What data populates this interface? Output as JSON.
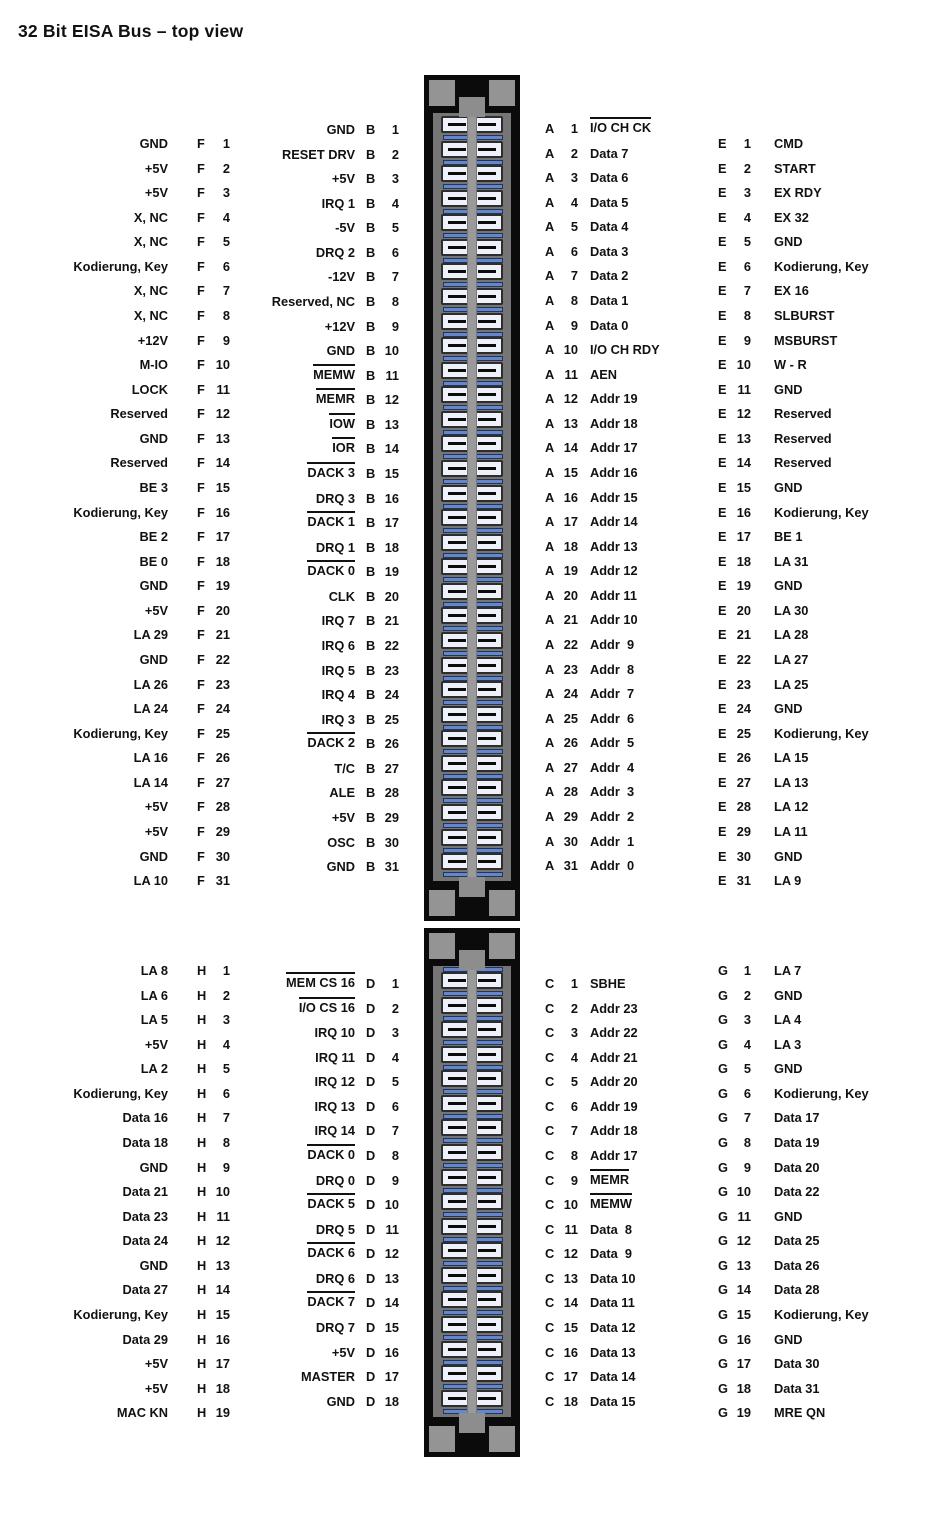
{
  "title": "32 Bit EISA Bus – top view",
  "colors": {
    "background": "#ffffff",
    "text": "#111111",
    "connector_black": "#0b0b0b",
    "key_pad_gray": "#949494",
    "panel_gray": "#757575",
    "center_bar_gray": "#9a9a9a",
    "cell_fill": "#eff1fa",
    "separator_blue": "#6486cf"
  },
  "connectors": {
    "top": {
      "cells": 31
    },
    "bottom": {
      "cells": 18
    }
  },
  "columns": [
    {
      "key": "f",
      "letter": "F",
      "section": "top",
      "pins": [
        {
          "n": "1",
          "label": "GND"
        },
        {
          "n": "2",
          "label": "+5V"
        },
        {
          "n": "3",
          "label": "+5V"
        },
        {
          "n": "4",
          "label": "X, NC"
        },
        {
          "n": "5",
          "label": "X, NC"
        },
        {
          "n": "6",
          "label": "Kodierung, Key"
        },
        {
          "n": "7",
          "label": "X, NC"
        },
        {
          "n": "8",
          "label": "X, NC"
        },
        {
          "n": "9",
          "label": "+12V"
        },
        {
          "n": "10",
          "label": "M-IO"
        },
        {
          "n": "11",
          "label": "LOCK"
        },
        {
          "n": "12",
          "label": "Reserved"
        },
        {
          "n": "13",
          "label": "GND"
        },
        {
          "n": "14",
          "label": "Reserved"
        },
        {
          "n": "15",
          "label": "BE 3"
        },
        {
          "n": "16",
          "label": "Kodierung, Key"
        },
        {
          "n": "17",
          "label": "BE 2"
        },
        {
          "n": "18",
          "label": "BE 0"
        },
        {
          "n": "19",
          "label": "GND"
        },
        {
          "n": "20",
          "label": "+5V"
        },
        {
          "n": "21",
          "label": "LA 29"
        },
        {
          "n": "22",
          "label": "GND"
        },
        {
          "n": "23",
          "label": "LA 26"
        },
        {
          "n": "24",
          "label": "LA 24"
        },
        {
          "n": "25",
          "label": "Kodierung, Key"
        },
        {
          "n": "26",
          "label": "LA 16"
        },
        {
          "n": "27",
          "label": "LA 14"
        },
        {
          "n": "28",
          "label": "+5V"
        },
        {
          "n": "29",
          "label": "+5V"
        },
        {
          "n": "30",
          "label": "GND"
        },
        {
          "n": "31",
          "label": "LA 10"
        }
      ]
    },
    {
      "key": "b",
      "letter": "B",
      "section": "top",
      "pins": [
        {
          "n": "1",
          "label": "GND"
        },
        {
          "n": "2",
          "label": "RESET DRV"
        },
        {
          "n": "3",
          "label": "+5V"
        },
        {
          "n": "4",
          "label": "IRQ 1"
        },
        {
          "n": "5",
          "label": "-5V"
        },
        {
          "n": "6",
          "label": "DRQ 2"
        },
        {
          "n": "7",
          "label": "-12V"
        },
        {
          "n": "8",
          "label": "Reserved, NC"
        },
        {
          "n": "9",
          "label": "+12V"
        },
        {
          "n": "10",
          "label": "GND"
        },
        {
          "n": "11",
          "label": "MEMW",
          "ov": true
        },
        {
          "n": "12",
          "label": "MEMR",
          "ov": true
        },
        {
          "n": "13",
          "label": "IOW",
          "ov": true
        },
        {
          "n": "14",
          "label": "IOR",
          "ov": true
        },
        {
          "n": "15",
          "label": "DACK 3",
          "ov": true
        },
        {
          "n": "16",
          "label": "DRQ 3"
        },
        {
          "n": "17",
          "label": "DACK 1",
          "ov": true
        },
        {
          "n": "18",
          "label": "DRQ 1"
        },
        {
          "n": "19",
          "label": "DACK 0",
          "ov": true
        },
        {
          "n": "20",
          "label": "CLK"
        },
        {
          "n": "21",
          "label": "IRQ 7"
        },
        {
          "n": "22",
          "label": "IRQ 6"
        },
        {
          "n": "23",
          "label": "IRQ 5"
        },
        {
          "n": "24",
          "label": "IRQ 4"
        },
        {
          "n": "25",
          "label": "IRQ 3"
        },
        {
          "n": "26",
          "label": "DACK 2",
          "ov": true
        },
        {
          "n": "27",
          "label": "T/C"
        },
        {
          "n": "28",
          "label": "ALE"
        },
        {
          "n": "29",
          "label": "+5V"
        },
        {
          "n": "30",
          "label": "OSC"
        },
        {
          "n": "31",
          "label": "GND"
        }
      ]
    },
    {
      "key": "a",
      "letter": "A",
      "section": "top",
      "pins": [
        {
          "n": "1",
          "label": "I/O CH CK",
          "ov": true
        },
        {
          "n": "2",
          "label": "Data 7"
        },
        {
          "n": "3",
          "label": "Data 6"
        },
        {
          "n": "4",
          "label": "Data 5"
        },
        {
          "n": "5",
          "label": "Data 4"
        },
        {
          "n": "6",
          "label": "Data 3"
        },
        {
          "n": "7",
          "label": "Data 2"
        },
        {
          "n": "8",
          "label": "Data 1"
        },
        {
          "n": "9",
          "label": "Data 0"
        },
        {
          "n": "10",
          "label": "I/O CH RDY"
        },
        {
          "n": "11",
          "label": "AEN"
        },
        {
          "n": "12",
          "label": "Addr 19"
        },
        {
          "n": "13",
          "label": "Addr 18"
        },
        {
          "n": "14",
          "label": "Addr 17"
        },
        {
          "n": "15",
          "label": "Addr 16"
        },
        {
          "n": "16",
          "label": "Addr 15"
        },
        {
          "n": "17",
          "label": "Addr 14"
        },
        {
          "n": "18",
          "label": "Addr 13"
        },
        {
          "n": "19",
          "label": "Addr 12"
        },
        {
          "n": "20",
          "label": "Addr 11"
        },
        {
          "n": "21",
          "label": "Addr 10"
        },
        {
          "n": "22",
          "label": "Addr  9"
        },
        {
          "n": "23",
          "label": "Addr  8"
        },
        {
          "n": "24",
          "label": "Addr  7"
        },
        {
          "n": "25",
          "label": "Addr  6"
        },
        {
          "n": "26",
          "label": "Addr  5"
        },
        {
          "n": "27",
          "label": "Addr  4"
        },
        {
          "n": "28",
          "label": "Addr  3"
        },
        {
          "n": "29",
          "label": "Addr  2"
        },
        {
          "n": "30",
          "label": "Addr  1"
        },
        {
          "n": "31",
          "label": "Addr  0"
        }
      ]
    },
    {
      "key": "e",
      "letter": "E",
      "section": "top",
      "pins": [
        {
          "n": "1",
          "label": "CMD"
        },
        {
          "n": "2",
          "label": "START"
        },
        {
          "n": "3",
          "label": "EX RDY"
        },
        {
          "n": "4",
          "label": "EX 32"
        },
        {
          "n": "5",
          "label": "GND"
        },
        {
          "n": "6",
          "label": "Kodierung, Key"
        },
        {
          "n": "7",
          "label": "EX 16"
        },
        {
          "n": "8",
          "label": "SLBURST"
        },
        {
          "n": "9",
          "label": "MSBURST"
        },
        {
          "n": "10",
          "label": "W - R"
        },
        {
          "n": "11",
          "label": "GND"
        },
        {
          "n": "12",
          "label": "Reserved"
        },
        {
          "n": "13",
          "label": "Reserved"
        },
        {
          "n": "14",
          "label": "Reserved"
        },
        {
          "n": "15",
          "label": "GND"
        },
        {
          "n": "16",
          "label": "Kodierung, Key"
        },
        {
          "n": "17",
          "label": "BE 1"
        },
        {
          "n": "18",
          "label": "LA 31"
        },
        {
          "n": "19",
          "label": "GND"
        },
        {
          "n": "20",
          "label": "LA 30"
        },
        {
          "n": "21",
          "label": "LA 28"
        },
        {
          "n": "22",
          "label": "LA 27"
        },
        {
          "n": "23",
          "label": "LA 25"
        },
        {
          "n": "24",
          "label": "GND"
        },
        {
          "n": "25",
          "label": "Kodierung, Key"
        },
        {
          "n": "26",
          "label": "LA 15"
        },
        {
          "n": "27",
          "label": "LA 13"
        },
        {
          "n": "28",
          "label": "LA 12"
        },
        {
          "n": "29",
          "label": "LA 11"
        },
        {
          "n": "30",
          "label": "GND"
        },
        {
          "n": "31",
          "label": "LA 9"
        }
      ]
    },
    {
      "key": "h",
      "letter": "H",
      "section": "bottom",
      "pins": [
        {
          "n": "1",
          "label": "LA 8"
        },
        {
          "n": "2",
          "label": "LA 6"
        },
        {
          "n": "3",
          "label": "LA 5"
        },
        {
          "n": "4",
          "label": "+5V"
        },
        {
          "n": "5",
          "label": "LA 2"
        },
        {
          "n": "6",
          "label": "Kodierung, Key"
        },
        {
          "n": "7",
          "label": "Data 16"
        },
        {
          "n": "8",
          "label": "Data 18"
        },
        {
          "n": "9",
          "label": "GND"
        },
        {
          "n": "10",
          "label": "Data 21"
        },
        {
          "n": "11",
          "label": "Data 23"
        },
        {
          "n": "12",
          "label": "Data 24"
        },
        {
          "n": "13",
          "label": "GND"
        },
        {
          "n": "14",
          "label": "Data 27"
        },
        {
          "n": "15",
          "label": "Kodierung, Key"
        },
        {
          "n": "16",
          "label": "Data 29"
        },
        {
          "n": "17",
          "label": "+5V"
        },
        {
          "n": "18",
          "label": "+5V"
        },
        {
          "n": "19",
          "label": "MAC KN"
        }
      ]
    },
    {
      "key": "d",
      "letter": "D",
      "section": "bottom",
      "pins": [
        {
          "n": "1",
          "label": "MEM CS 16",
          "ov": true
        },
        {
          "n": "2",
          "label": "I/O CS 16",
          "ov": true
        },
        {
          "n": "3",
          "label": "IRQ 10"
        },
        {
          "n": "4",
          "label": "IRQ 11"
        },
        {
          "n": "5",
          "label": "IRQ 12"
        },
        {
          "n": "6",
          "label": "IRQ 13"
        },
        {
          "n": "7",
          "label": "IRQ 14"
        },
        {
          "n": "8",
          "label": "DACK 0",
          "ov": true
        },
        {
          "n": "9",
          "label": "DRQ 0"
        },
        {
          "n": "10",
          "label": "DACK 5",
          "ov": true
        },
        {
          "n": "11",
          "label": "DRQ 5"
        },
        {
          "n": "12",
          "label": "DACK 6",
          "ov": true
        },
        {
          "n": "13",
          "label": "DRQ 6"
        },
        {
          "n": "14",
          "label": "DACK 7",
          "ov": true
        },
        {
          "n": "15",
          "label": "DRQ 7"
        },
        {
          "n": "16",
          "label": "+5V"
        },
        {
          "n": "17",
          "label": "MASTER"
        },
        {
          "n": "18",
          "label": "GND"
        }
      ]
    },
    {
      "key": "c",
      "letter": "C",
      "section": "bottom",
      "pins": [
        {
          "n": "1",
          "label": "SBHE"
        },
        {
          "n": "2",
          "label": "Addr 23"
        },
        {
          "n": "3",
          "label": "Addr 22"
        },
        {
          "n": "4",
          "label": "Addr 21"
        },
        {
          "n": "5",
          "label": "Addr 20"
        },
        {
          "n": "6",
          "label": "Addr 19"
        },
        {
          "n": "7",
          "label": "Addr 18"
        },
        {
          "n": "8",
          "label": "Addr 17"
        },
        {
          "n": "9",
          "label": "MEMR",
          "ov": true
        },
        {
          "n": "10",
          "label": "MEMW",
          "ov": true
        },
        {
          "n": "11",
          "label": "Data  8"
        },
        {
          "n": "12",
          "label": "Data  9"
        },
        {
          "n": "13",
          "label": "Data 10"
        },
        {
          "n": "14",
          "label": "Data 11"
        },
        {
          "n": "15",
          "label": "Data 12"
        },
        {
          "n": "16",
          "label": "Data 13"
        },
        {
          "n": "17",
          "label": "Data 14"
        },
        {
          "n": "18",
          "label": "Data 15"
        }
      ]
    },
    {
      "key": "g",
      "letter": "G",
      "section": "bottom",
      "pins": [
        {
          "n": "1",
          "label": "LA 7"
        },
        {
          "n": "2",
          "label": "GND"
        },
        {
          "n": "3",
          "label": "LA 4"
        },
        {
          "n": "4",
          "label": "LA 3"
        },
        {
          "n": "5",
          "label": "GND"
        },
        {
          "n": "6",
          "label": "Kodierung, Key"
        },
        {
          "n": "7",
          "label": "Data 17"
        },
        {
          "n": "8",
          "label": "Data 19"
        },
        {
          "n": "9",
          "label": "Data 20"
        },
        {
          "n": "10",
          "label": "Data 22"
        },
        {
          "n": "11",
          "label": "GND"
        },
        {
          "n": "12",
          "label": "Data 25"
        },
        {
          "n": "13",
          "label": "Data 26"
        },
        {
          "n": "14",
          "label": "Data 28"
        },
        {
          "n": "15",
          "label": "Kodierung, Key"
        },
        {
          "n": "16",
          "label": "GND"
        },
        {
          "n": "17",
          "label": "Data 30"
        },
        {
          "n": "18",
          "label": "Data 31"
        },
        {
          "n": "19",
          "label": "MRE QN"
        }
      ]
    }
  ]
}
